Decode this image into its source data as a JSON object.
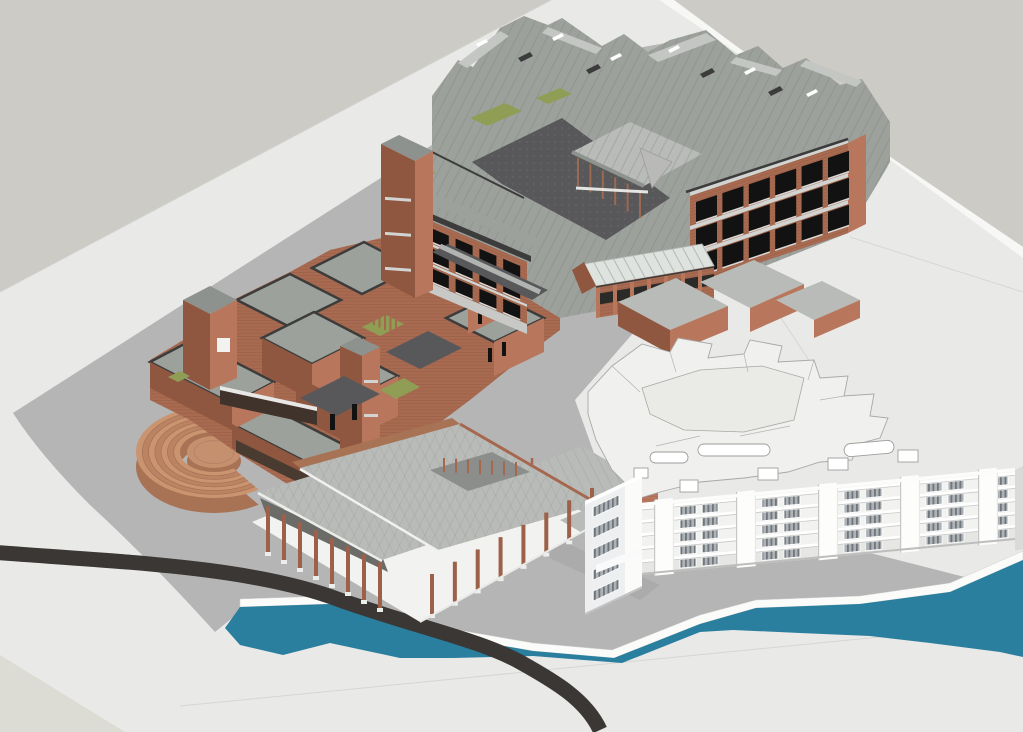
{
  "scene": {
    "type": "architectural-axonometric-3d-render",
    "description": "Aerial axonometric rendering of a brick school campus beside a river: a large courtyard teaching complex (top), a cluster of small brick pavilion volumes with green courtyards (left), a semicircular brick amphitheater, an open colonnade hall under construction (bottom center), an existing white residential block drawn in white wireframe style (right), a teal river with white embankment paths and a black curved road.",
    "colors": {
      "background": "#cccbc5",
      "ground_plane": "#e9e9e8",
      "ground_plane_bright": "#f7f7f5",
      "ground_plane_beige": "#dcdcd4",
      "site_plane": "#b5b5b6",
      "fold_line": "#d6d6d3",
      "pavement_dark": "#58585a",
      "brick": "#a86a50",
      "brick_light": "#b8775c",
      "brick_dark": "#8f5640",
      "amph_brick": "#c4906e",
      "amph_brick_dark": "#a87254",
      "roof": "#9da19c",
      "roof_light": "#c3c6c2",
      "roof_plate": "#b8bbb7",
      "roof_dark": "#8e928e",
      "edge_dark": "#3c3c3c",
      "concrete_band": "#d2d4d2",
      "courtyard_green": "#8f9d55",
      "glass_roof": "#dfe3df",
      "river": "#2a7e9e",
      "road": "#3a3734",
      "white": "#ffffff",
      "white_dim": "#f0f0ee",
      "outline_gray": "#a8a8a6",
      "window_dark": "#121212",
      "window_stripe": "#70767b",
      "window_stripe_bg": "#aeb3b7"
    },
    "elements": [
      "background",
      "ground-plane",
      "site-plane",
      "teaching-complex",
      "campus-cluster",
      "courtyard-pavilion",
      "glass-roofed-hall",
      "amphitheater",
      "colonnade-hall",
      "white-residential-building",
      "riverside-path",
      "river",
      "road",
      "courtyard-greens"
    ],
    "params": {
      "amphitheater": {
        "cx": 214,
        "cy": 452,
        "outer_rx": 78,
        "outer_ry": 46,
        "inner_rx": 34,
        "inner_ry": 20,
        "rings": 7,
        "gap_start_deg": 55,
        "gap_end_deg": 330,
        "wall_height": 15
      },
      "white_building": {
        "floors": 5,
        "facade_w": 375,
        "facade_h": 66,
        "piers": [
          14,
          96,
          178,
          260,
          338
        ],
        "window_x": [
          40,
          62,
          122,
          144,
          204,
          226,
          286,
          308,
          352
        ],
        "window_w": 16,
        "window_h": 8.5
      },
      "left_wing_windows": {
        "rows": 3,
        "cols": 5
      },
      "right_wing_windows": {
        "rows": 3,
        "cols": 6
      },
      "colonnade": {
        "piers_nw": 8,
        "piers_se": 8
      },
      "glasshouse": {
        "mullions": 12
      },
      "pavilion": {
        "posts": 6
      }
    }
  }
}
